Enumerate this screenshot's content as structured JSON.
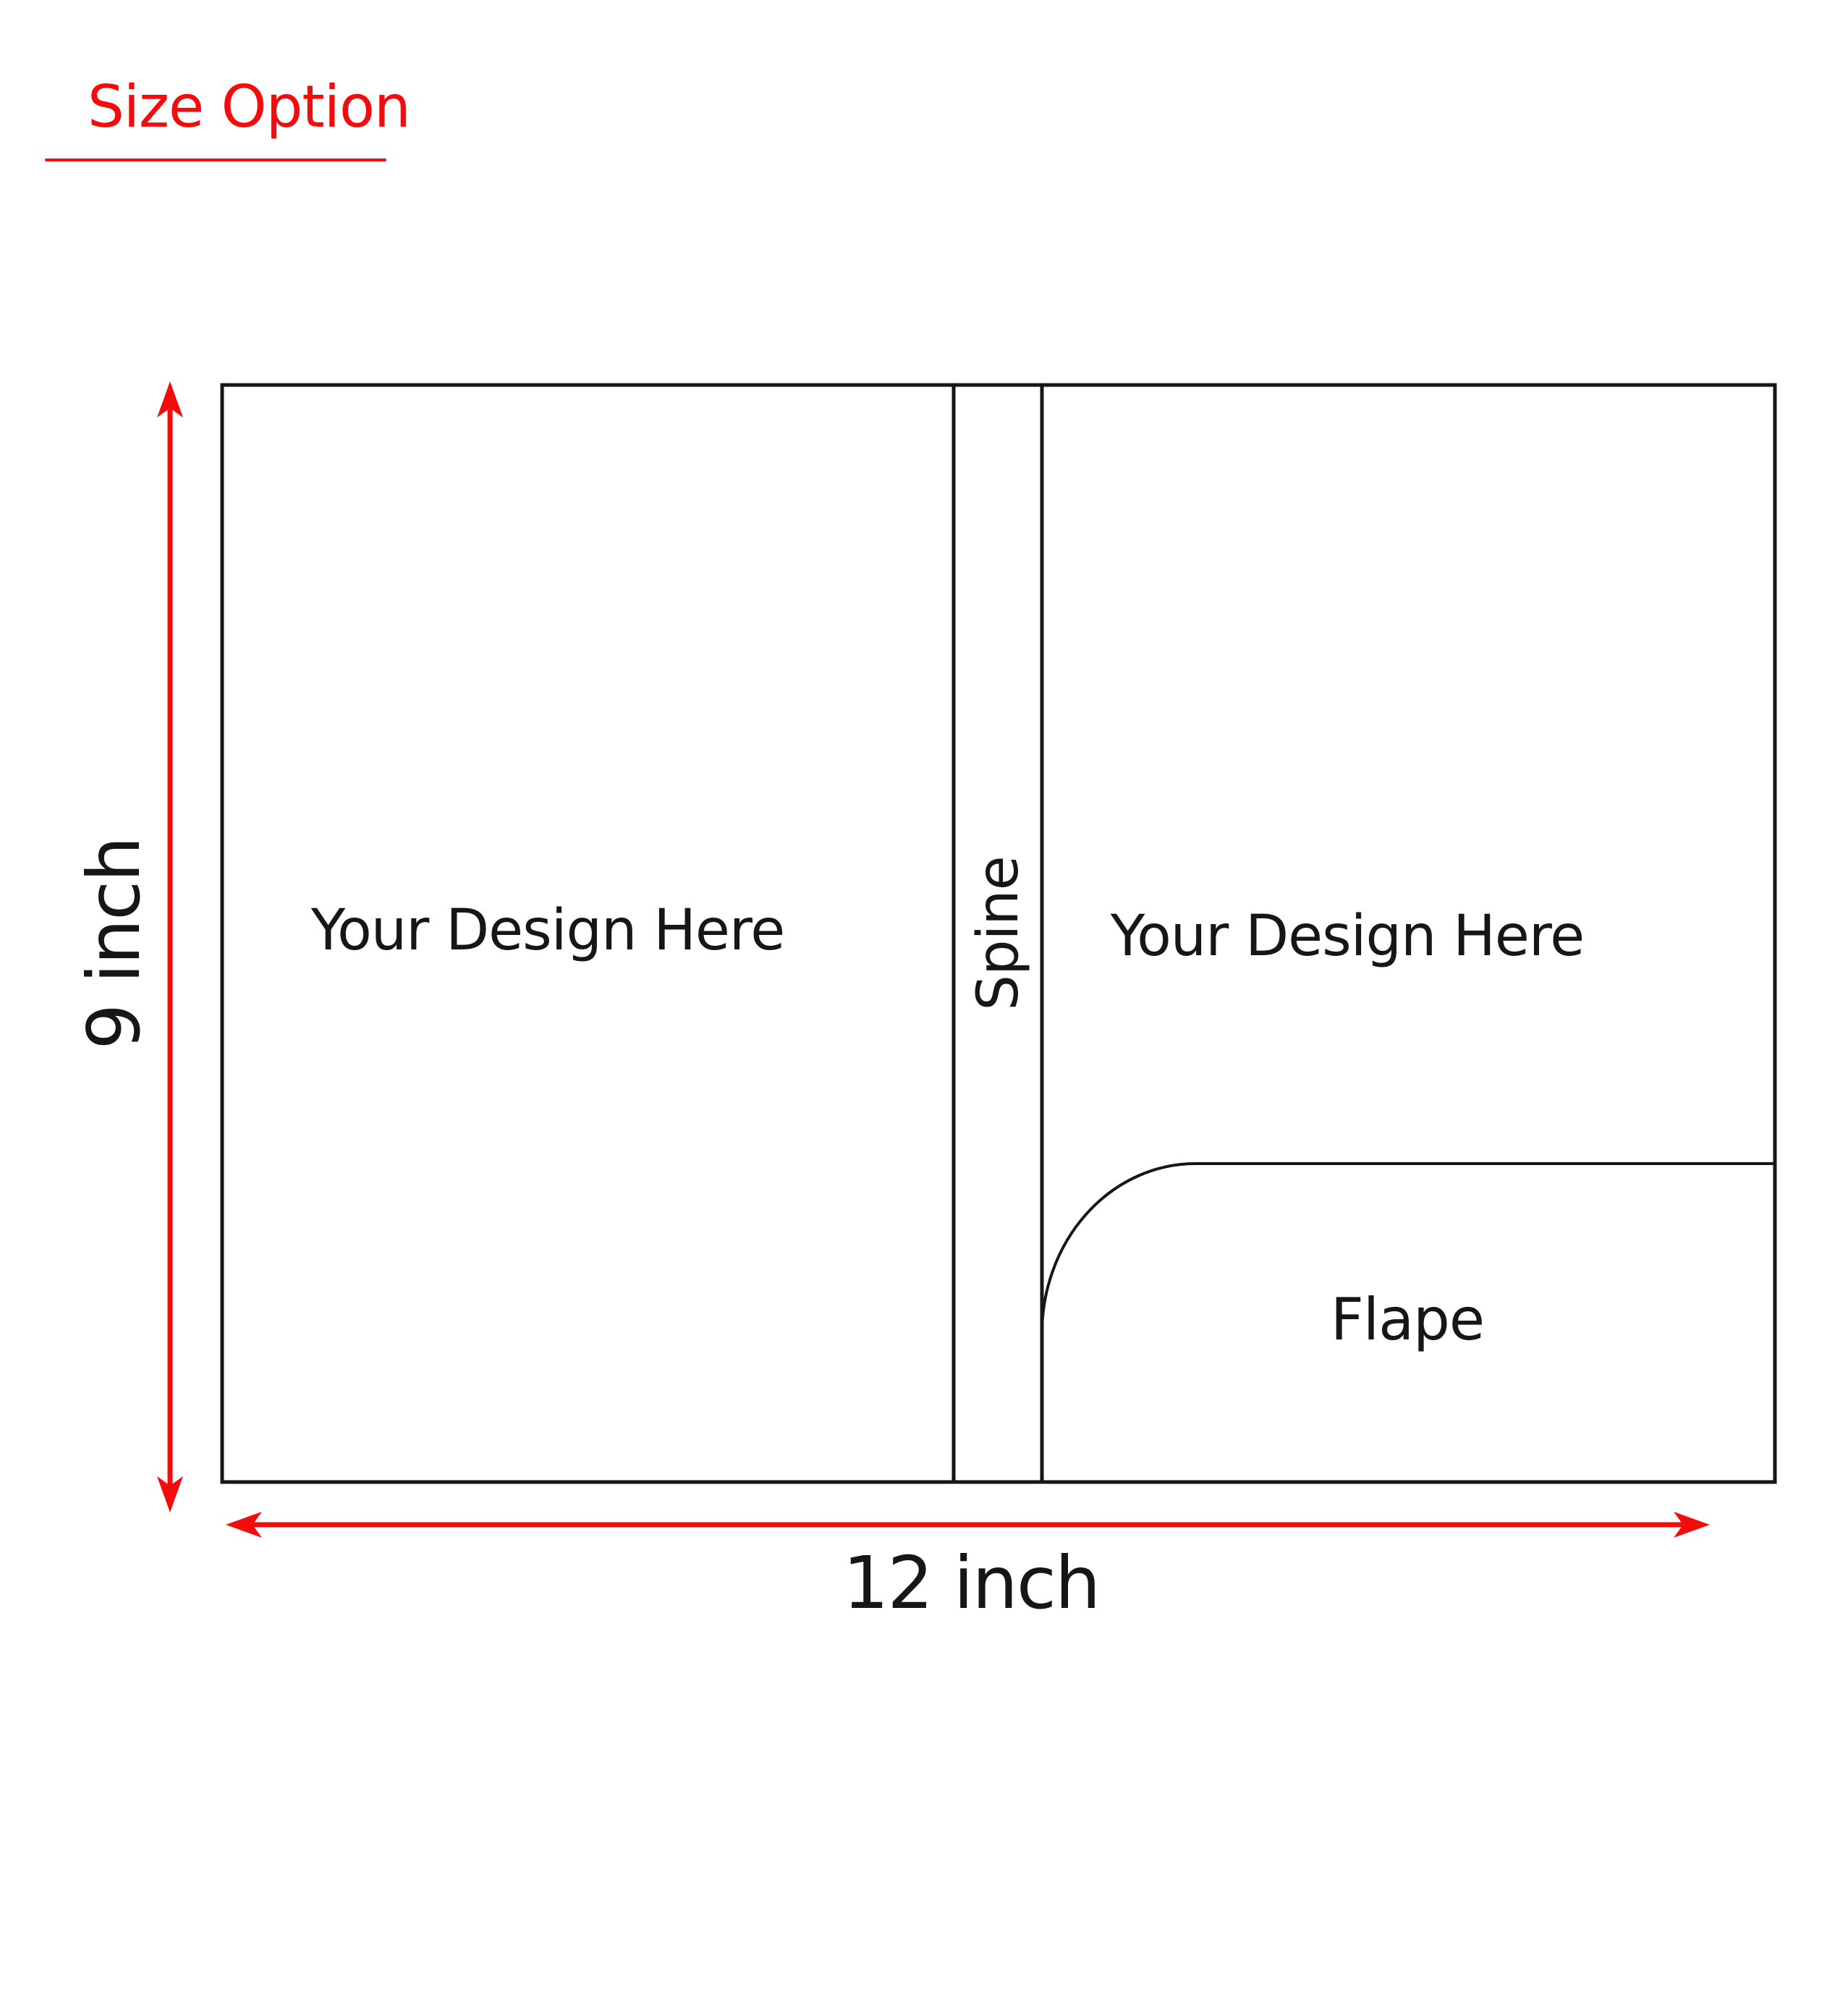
{
  "title": "Size Option",
  "colors": {
    "accent_red": "#f40b0b",
    "line_black": "#161616"
  },
  "diagram": {
    "left_panel_label": "Your Design Here",
    "spine_label": "Spine",
    "right_panel_label": "Your Design Here",
    "flap_label": "Flape"
  },
  "dimensions": {
    "height_label": "9 inch",
    "width_label": "12 inch"
  }
}
